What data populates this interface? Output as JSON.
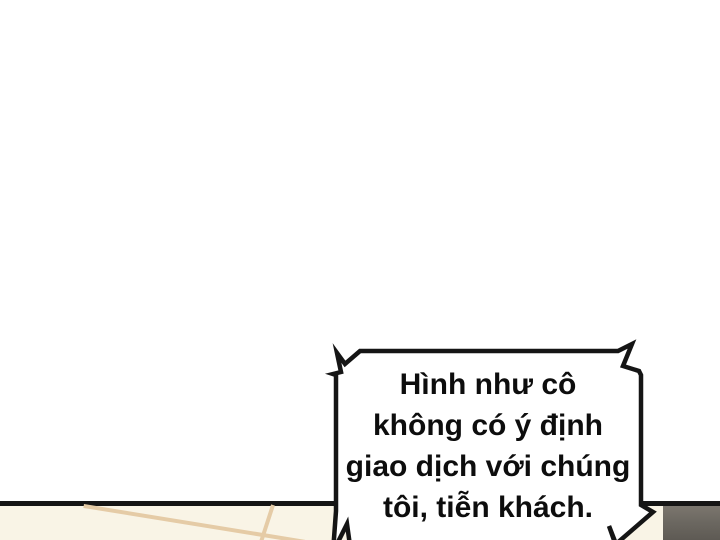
{
  "panel": {
    "background_color": "#ffffff",
    "border_line_color": "#151515",
    "floor": {
      "surface_color": "#f9f4e6",
      "plank_line_color": "#e5cba6"
    },
    "corner_object_color": "#6b6760"
  },
  "speech_bubble": {
    "shape": "spiked-rectangle",
    "fill_color": "#ffffff",
    "border_color": "#151515",
    "text_color": "#0d0d0d",
    "lines": [
      "Hình như cô",
      "không có ý định",
      "giao dịch với chúng",
      "tôi, tiễn khách."
    ],
    "full_text": "Hình như cô không có ý định giao dịch với chúng tôi, tiễn khách."
  }
}
